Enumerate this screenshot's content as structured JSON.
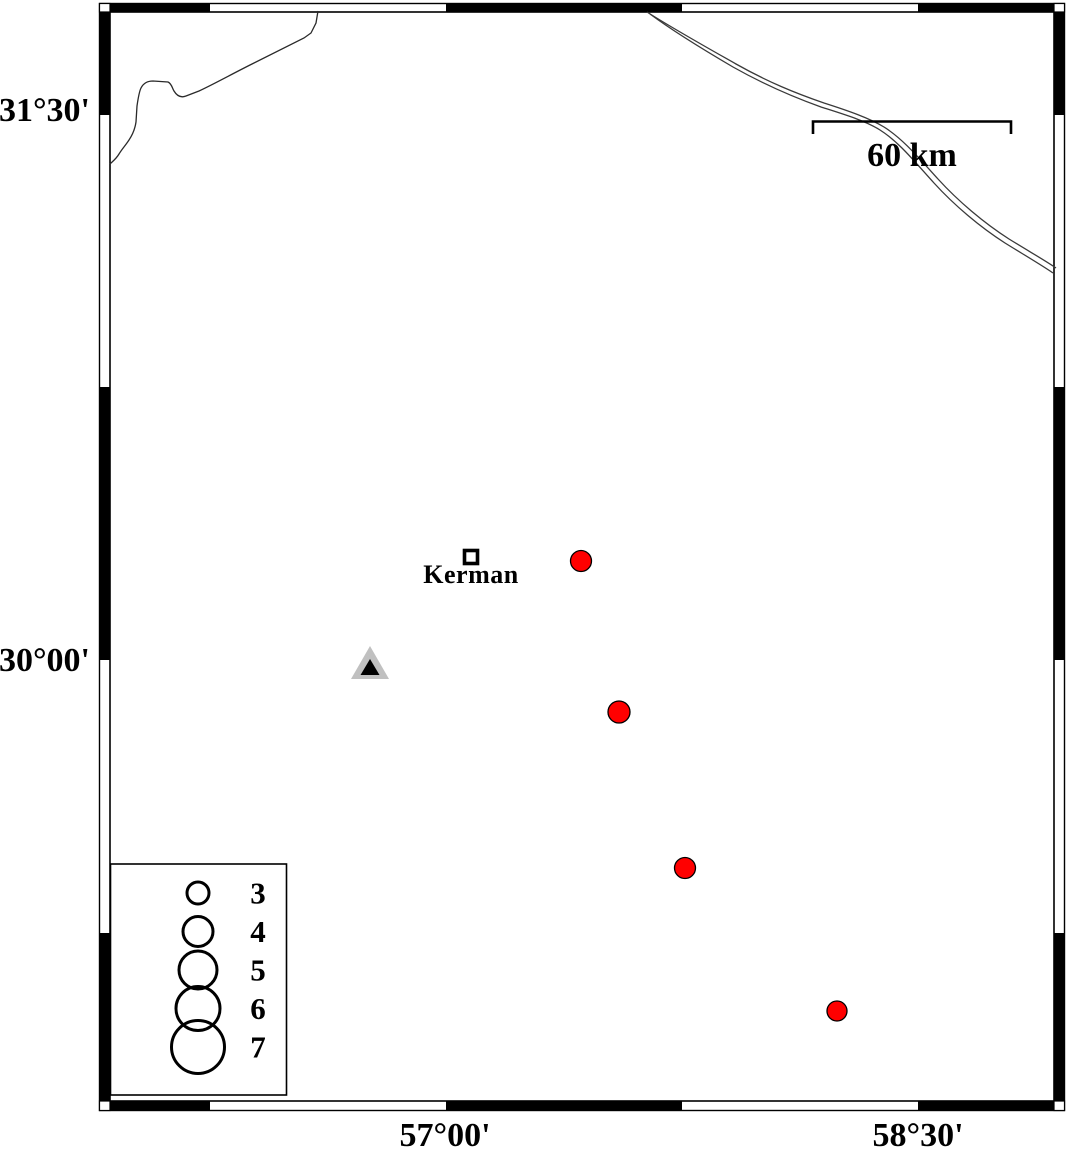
{
  "frame": {
    "left_labels": [
      "31°30'",
      "30°00'"
    ],
    "bottom_labels": [
      "57°00'",
      "58°30'"
    ]
  },
  "scale_bar": {
    "label": "60 km"
  },
  "city": {
    "name": "Kerman",
    "x": 471,
    "y": 557
  },
  "station": {
    "x": 370,
    "y": 663
  },
  "earthquakes": [
    {
      "x": 581,
      "y": 561,
      "r": 10.5
    },
    {
      "x": 619,
      "y": 712,
      "r": 11
    },
    {
      "x": 685,
      "y": 868,
      "r": 10.5
    },
    {
      "x": 837,
      "y": 1011,
      "r": 10
    }
  ],
  "legend": {
    "magnitudes": [
      {
        "label": "3",
        "radius": 11
      },
      {
        "label": "4",
        "radius": 15
      },
      {
        "label": "5",
        "radius": 19
      },
      {
        "label": "6",
        "radius": 22
      },
      {
        "label": "7",
        "radius": 26.5
      }
    ]
  },
  "colors": {
    "earthquake_fill": "#ff0000",
    "station_fill": "#c0c0c0",
    "station_core": "#000000",
    "frame_ink": "#000000"
  }
}
